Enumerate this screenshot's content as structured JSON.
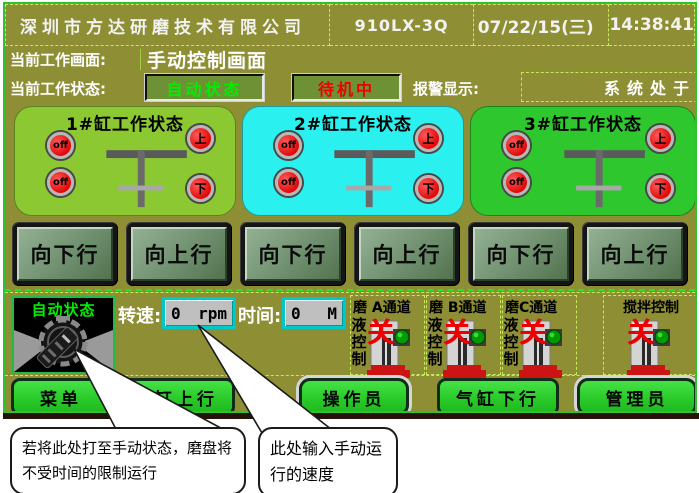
{
  "header": {
    "company": "深圳市方达研磨技术有限公司",
    "model": "910LX-3Q",
    "date": "07/22/15(三)",
    "time": "14:38:41"
  },
  "screen_row": {
    "label": "当前工作画面:",
    "value": "手动控制画面"
  },
  "status_row": {
    "label": "当前工作状态:",
    "mode": "自动状态",
    "standby": "待机中",
    "alarm_label": "报警显示:",
    "alarm_text": "系统处于"
  },
  "cylinders": [
    {
      "title": "1#缸工作状态",
      "left_lamps": [
        "off",
        "off"
      ],
      "right_lamps": [
        "上",
        "下"
      ],
      "bg": "#8cc832"
    },
    {
      "title": "2#缸工作状态",
      "left_lamps": [
        "off",
        "off"
      ],
      "right_lamps": [
        "上",
        "下"
      ],
      "bg": "#2bf0f0"
    },
    {
      "title": "3#缸工作状态",
      "left_lamps": [
        "off",
        "off"
      ],
      "right_lamps": [
        "上",
        "下"
      ],
      "bg": "#2ec82e"
    }
  ],
  "motion_buttons": [
    {
      "label": "向下行"
    },
    {
      "label": "向上行"
    },
    {
      "label": "向下行"
    },
    {
      "label": "向上行"
    },
    {
      "label": "向下行"
    },
    {
      "label": "向上行"
    }
  ],
  "manual": {
    "knob_label": "自动状态",
    "speed_label": "转速:",
    "speed_value": "0",
    "speed_unit": "rpm",
    "time_label": "时间:",
    "time_value": "0",
    "time_unit": "M"
  },
  "channels": [
    {
      "title": "磨 A通道",
      "side": "液控制",
      "state": "关"
    },
    {
      "title": "磨 B通道",
      "side": "液控制",
      "state": "关"
    },
    {
      "title": "磨C通道",
      "side": "液控制",
      "state": "关"
    },
    {
      "title": "搅拌控制",
      "side": "",
      "state": "关"
    }
  ],
  "bottom_buttons": [
    {
      "label": "菜单"
    },
    {
      "label": "气缸上行"
    },
    {
      "label": "操作员"
    },
    {
      "label": "气缸下行"
    },
    {
      "label": "管理员"
    }
  ],
  "callouts": [
    {
      "text": "若将此处打至手动状态，磨盘将不受时间的限制运行"
    },
    {
      "text": "此处输入手动运行的速度"
    }
  ],
  "colors": {
    "screen_bg": "#8e8e35",
    "panel1": "#8cc832",
    "panel2": "#2bf0f0",
    "panel3": "#2ec82e",
    "lamp_red": "#e00808",
    "mode_text": "#00ee00",
    "standby_text": "#ee0000",
    "bottom_button": "#28c828",
    "input_border": "#00c8c8",
    "valve_state": "#ee0000"
  }
}
